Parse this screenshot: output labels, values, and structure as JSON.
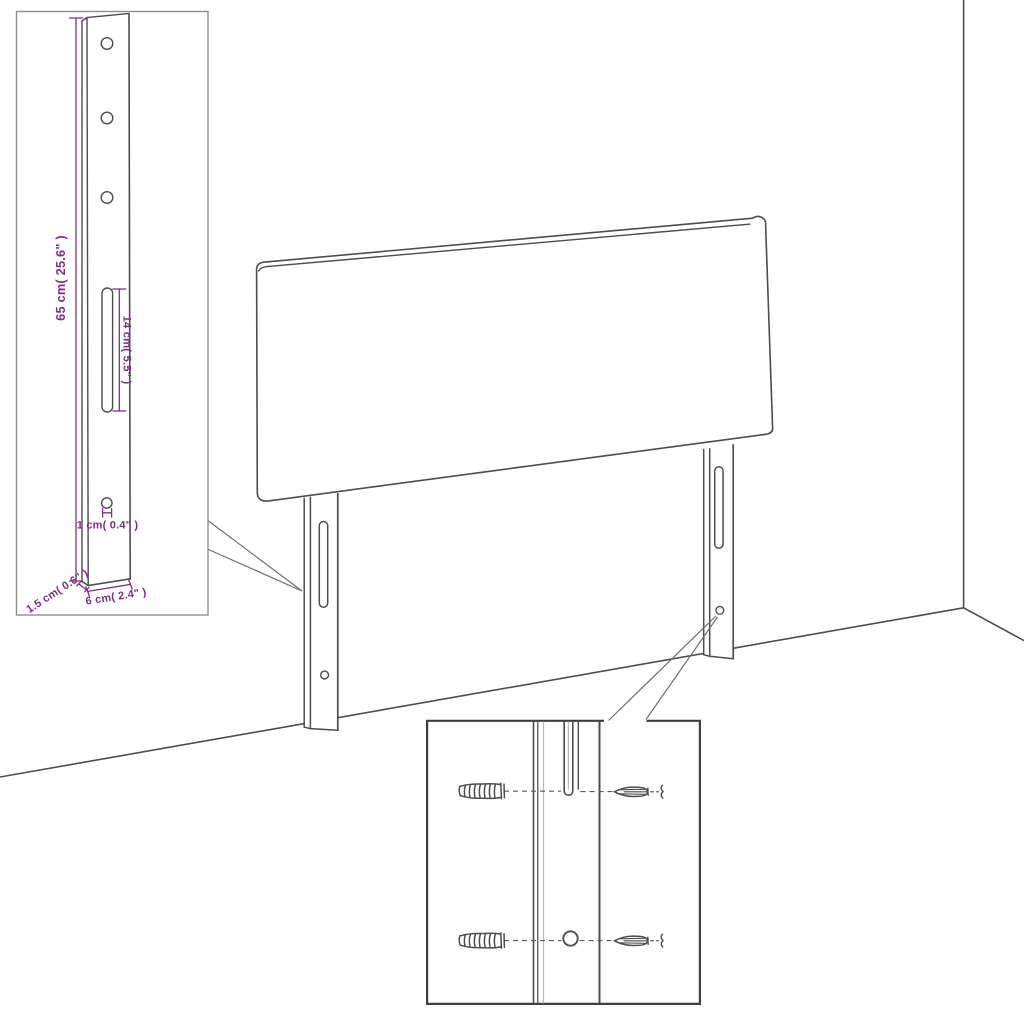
{
  "colors": {
    "accent": "#7e2f82",
    "line": "#4d4d4d",
    "light_line": "#b8b8b8",
    "inset_border": "#8f8f8f",
    "hardware_inset_border": "#3f3f3f",
    "background": "#ffffff"
  },
  "leg_detail_inset": {
    "dimensions": {
      "height_label": "65 cm( 25.6\" )",
      "slot_length_label": "14 cm( 5.5\" )",
      "hole_offset_label": "1 cm( 0.4\" )",
      "thickness_label": "1.5 cm( 0.6\" )",
      "width_label": "6 cm( 2.4\" )"
    }
  }
}
